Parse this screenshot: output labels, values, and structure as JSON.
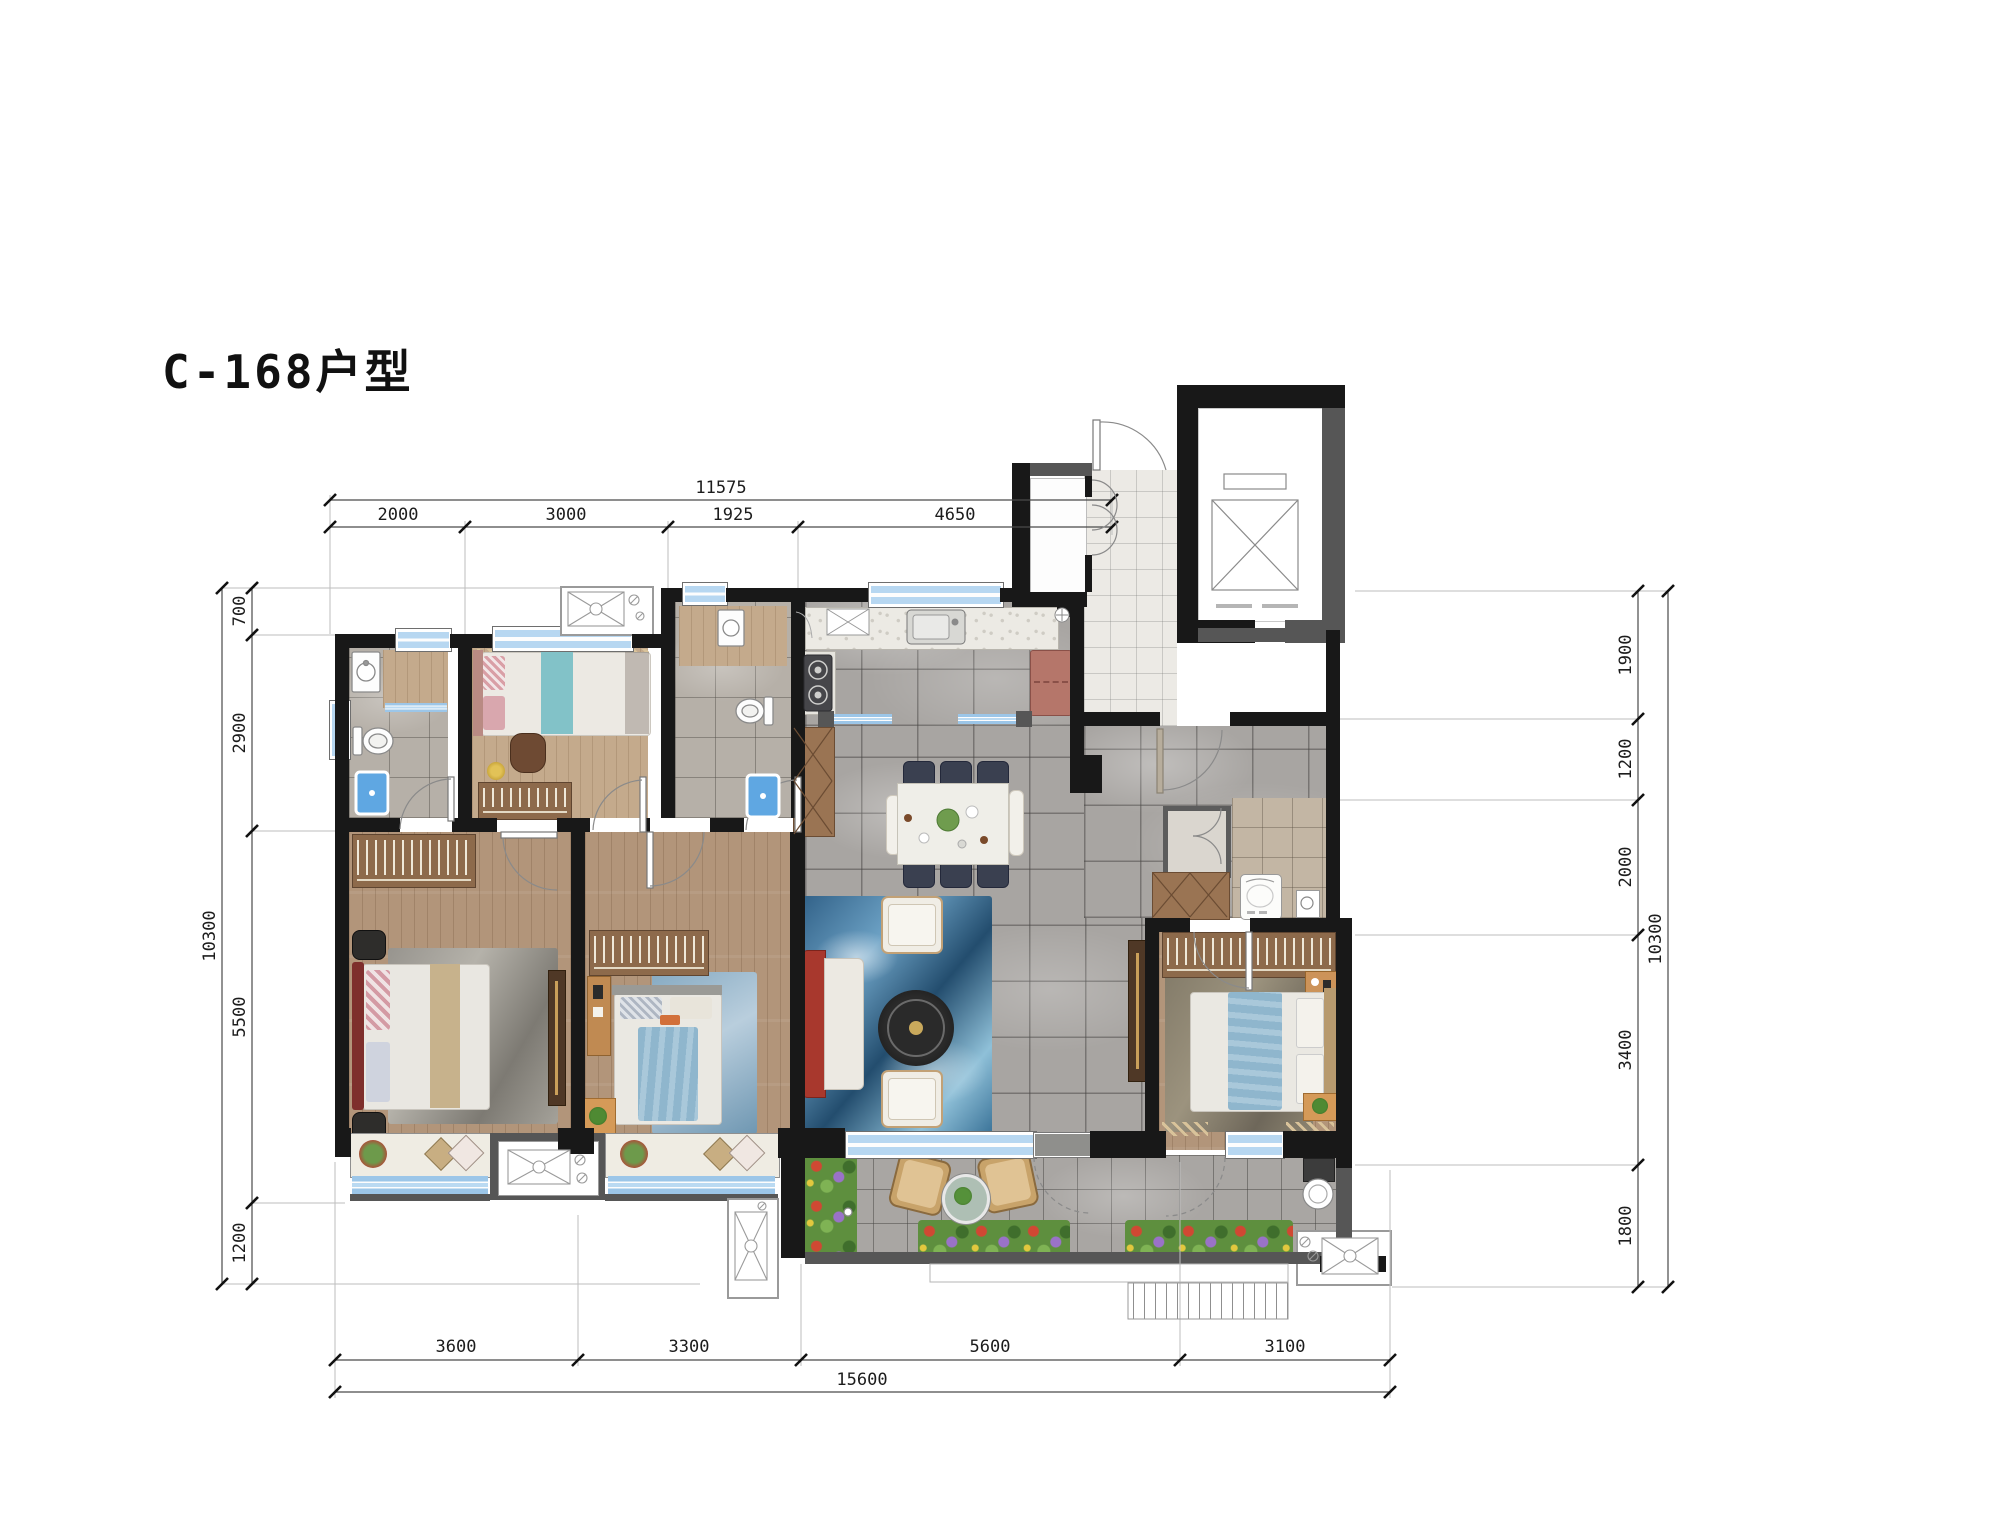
{
  "title": "C-168户型",
  "dimensions": {
    "top": {
      "total": "11575",
      "segments": [
        "2000",
        "3000",
        "1925",
        "4650"
      ]
    },
    "left": {
      "total": "10300",
      "segments": [
        "700",
        "2900",
        "5500",
        "1200"
      ]
    },
    "right": {
      "total": "10300",
      "segments": [
        "1900",
        "1200",
        "2000",
        "3400",
        "1800"
      ]
    },
    "bottom": {
      "total": "15600",
      "segments": [
        "3600",
        "3300",
        "5600",
        "3100"
      ]
    }
  },
  "colors": {
    "wall": "#181818",
    "secondary_wall": "#565656",
    "wood_floor": "#b2957a",
    "tile_floor": "#a8a5a2",
    "window_glass": "#b7d7f1",
    "rug_blue": "#2f5f86",
    "sofa_red": "#a8382d",
    "wardrobe": "#8d6a4b",
    "shower": "#5fa7e2",
    "dimension_text": "#1c1c1c"
  }
}
